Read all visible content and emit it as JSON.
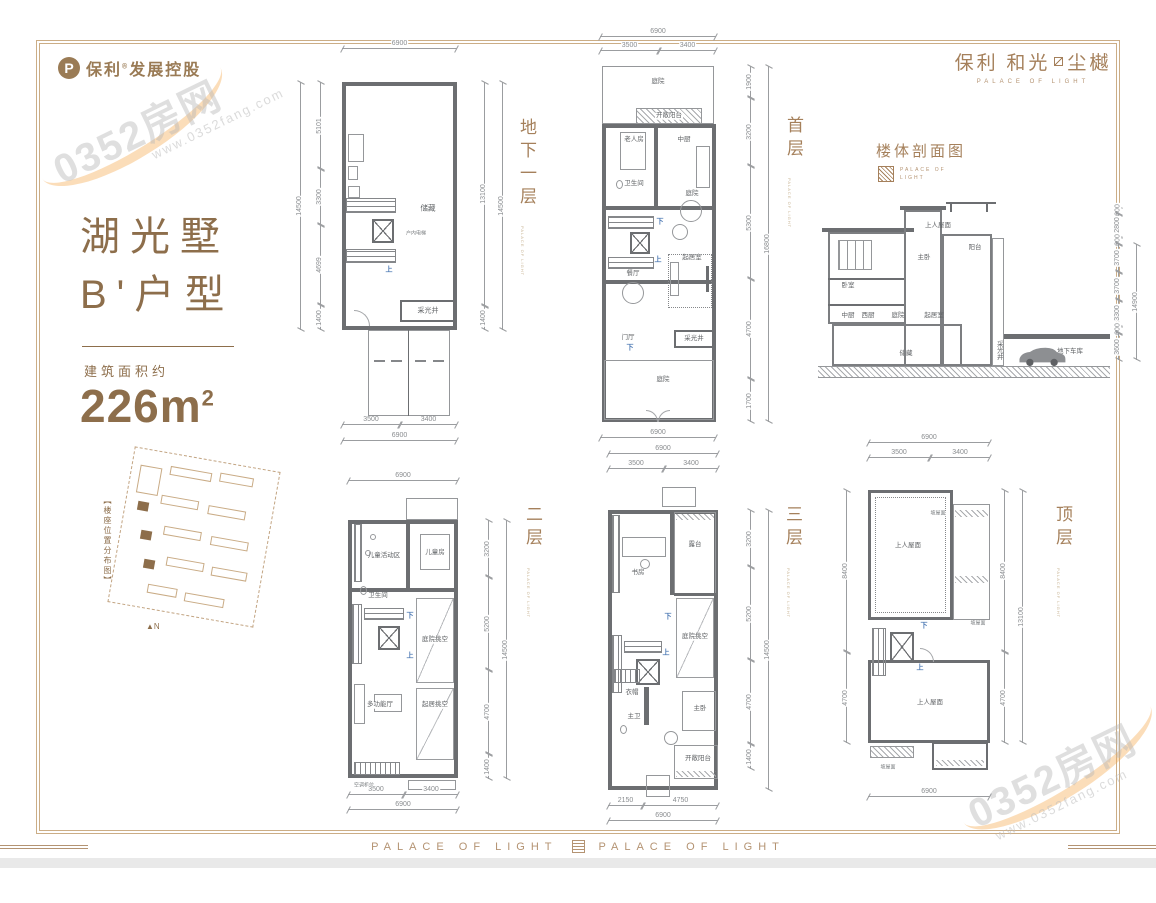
{
  "brand": {
    "left_name": "保利",
    "left_reg": "®",
    "left_rest": "发展控股",
    "p_letter": "P",
    "name1": "保利 和光",
    "name2": "尘樾",
    "sub": "PALACE OF LIGHT"
  },
  "unit": {
    "title1": "湖光墅",
    "title2": "B'户型",
    "area_label": "建筑面积约",
    "area_value": "226m",
    "area_sup": "2"
  },
  "siteplan": {
    "label": "【楼座位置分布图】",
    "north": "N"
  },
  "watermark": {
    "text": "0352房网",
    "url": "www.0352fang.com"
  },
  "plans": {
    "floor_sub": "PALACE OF LIGHT",
    "basement": {
      "label": "地下一层",
      "dims": {
        "top_total": "6900",
        "left_outer": "14500",
        "left": [
          "5101",
          "3300",
          "4699",
          "1400"
        ],
        "right_inner": "13100",
        "right_seg": "1400",
        "right_outer": "14500",
        "bottom": [
          "3500",
          "3400"
        ],
        "bottom_total": "6900"
      },
      "rooms": {
        "storage": "储藏",
        "lightwell": "采光井",
        "elevator": "户内电梯",
        "up": "上"
      }
    },
    "first": {
      "label": "首层",
      "dims": {
        "top_total": "6900",
        "top": [
          "3500",
          "3400"
        ],
        "right": [
          "1900",
          "3200",
          "5300",
          "4700",
          "1700"
        ],
        "right_outer": "16800",
        "bottom_total": "6900"
      },
      "rooms": {
        "courtyard_back": "庭院",
        "open_balcony": "开敞阳台",
        "elder_room": "老人房",
        "kitchen_cn": "中厨",
        "bath": "卫生间",
        "courtyard_mid": "庭院",
        "dining": "餐厅",
        "living": "起居室",
        "foyer": "门厅",
        "lightwell": "采光井",
        "courtyard_front": "庭院",
        "up": "上",
        "down": "下"
      }
    },
    "second": {
      "label": "二层",
      "dims": {
        "top_total": "6900",
        "right": [
          "3200",
          "5200",
          "4700",
          "1400"
        ],
        "right_outer": "14500",
        "bottom": [
          "3500",
          "3400"
        ],
        "bottom_total": "6900"
      },
      "rooms": {
        "kids_zone": "儿童活动区",
        "kids_room": "儿童房",
        "bath": "卫生间",
        "void_mid": "庭院挑空",
        "multi_hall": "多功能厅",
        "void_low": "起居挑空",
        "ac": "空调机位",
        "up": "上",
        "down": "下"
      }
    },
    "third": {
      "label": "三层",
      "dims": {
        "top_total": "6900",
        "top": [
          "3500",
          "3400"
        ],
        "right": [
          "3200",
          "5200",
          "4700",
          "1400"
        ],
        "right_outer": "14500",
        "bottom": [
          "2150",
          "4750"
        ],
        "bottom_total": "6900"
      },
      "rooms": {
        "study": "书房",
        "terrace": "露台",
        "void_mid": "庭院挑空",
        "cloak": "衣帽",
        "master_bath": "主卫",
        "master": "主卧",
        "open_balcony": "开敞阳台",
        "up": "上",
        "down": "下"
      }
    },
    "roof": {
      "label": "顶层",
      "dims": {
        "top_total": "6900",
        "top": [
          "3500",
          "3400"
        ],
        "left": [
          "8400",
          "4700"
        ],
        "right": [
          "8400",
          "4700"
        ],
        "right_outer": "13100",
        "bottom_total": "6900"
      },
      "rooms": {
        "roof_upper": "上人屋面",
        "roof_lower": "上人屋面",
        "slope": "坡屋面",
        "up": "上",
        "down": "下"
      }
    }
  },
  "section": {
    "title": "楼体剖面图",
    "logo_line1": "PALACE OF",
    "logo_line2": "LIGHT",
    "rooms": {
      "bedroom": "卧室",
      "kitchen_cn": "中厨",
      "kitchen_w": "西厨",
      "courtyard": "庭院",
      "living": "起居室",
      "master": "主卧",
      "roof": "上人屋面",
      "balcony": "阳台",
      "storage": "储藏",
      "lightwell": "采光井",
      "garage": "地下车库"
    },
    "dims_right": [
      "600",
      "2800",
      "600",
      "3700",
      "3700",
      "3300",
      "600",
      "3600"
    ],
    "dim_outer": "14900"
  },
  "footer": {
    "text": "PALACE OF LIGHT"
  }
}
